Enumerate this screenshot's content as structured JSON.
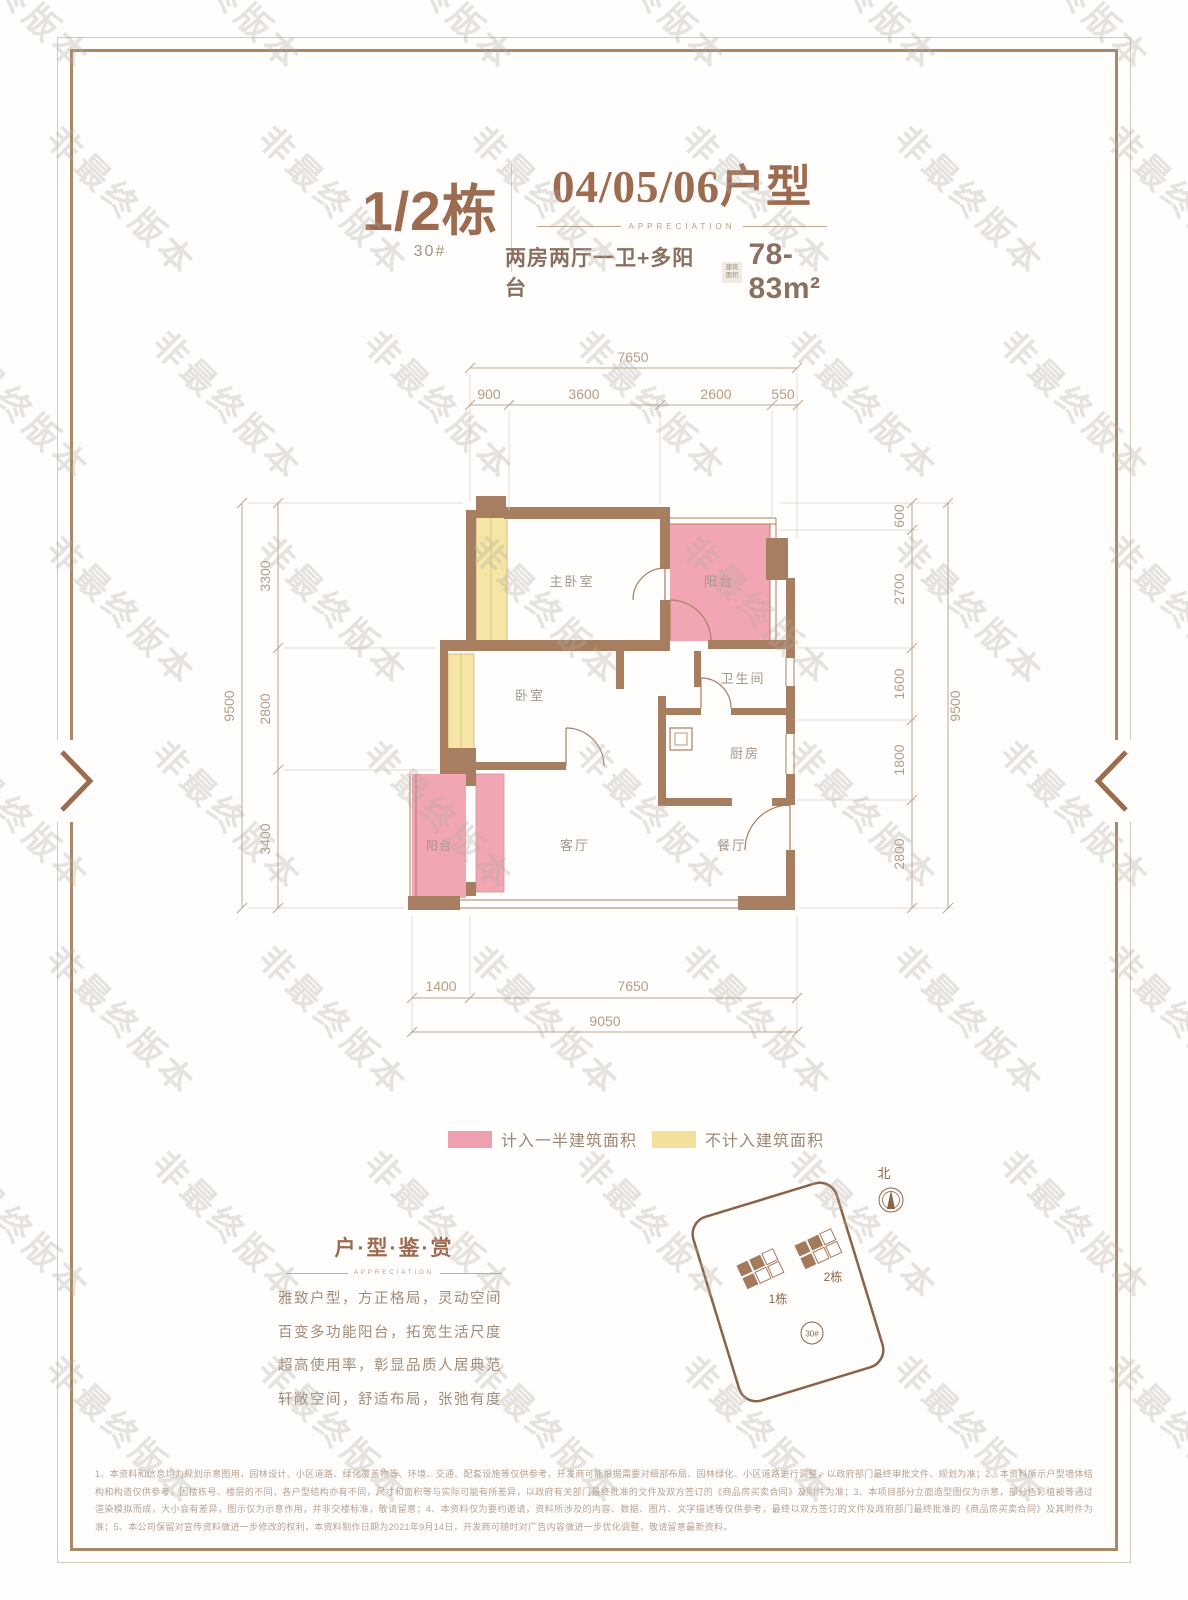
{
  "watermark": {
    "text": "非最终版本"
  },
  "colors": {
    "accent": "#9c6b50",
    "wall": "#a87e60",
    "half_area_pink": "#f2a6b4",
    "excluded_yellow": "#f5e6a6",
    "dim": "#bb9f88"
  },
  "header": {
    "building": "1/2栋",
    "building_no": "30#",
    "unit_title": "04/05/06户型",
    "unit_subtitle": "APPRECIATION",
    "layout_desc": "两房两厅一卫+多阳台",
    "area_badge_top": "建筑",
    "area_badge_bottom": "面积",
    "area_value": "78-83m²"
  },
  "plan": {
    "rooms": {
      "master": "主卧室",
      "balcony_top": "阳台",
      "bath": "卫生间",
      "kitchen": "厨房",
      "bedroom": "卧室",
      "living": "客厅",
      "dining": "餐厅",
      "balcony_bottom": "阳台"
    },
    "dims": {
      "top": {
        "overall": "7650",
        "segments": [
          "900",
          "3600",
          "2600",
          "550"
        ]
      },
      "left": {
        "overall": "9500",
        "segments": [
          "3300",
          "2800",
          "3400"
        ]
      },
      "right": {
        "overall": "9500",
        "segments": [
          "600",
          "2700",
          "1600",
          "1800",
          "2800"
        ]
      },
      "bottom": {
        "overall": "9050",
        "segments": [
          "1400",
          "7650"
        ]
      }
    }
  },
  "legend": {
    "half_area_label": "计入一半建筑面积",
    "excluded_label": "不计入建筑面积"
  },
  "appreciation": {
    "title": "户·型·鉴·赏",
    "subtitle": "APPRECIATION",
    "lines": [
      "雅致户型，方正格局，灵动空间",
      "百变多功能阳台，拓宽生活尺度",
      "超高使用率，彰显品质人居典范",
      "轩敞空间，舒适布局，张弛有度"
    ]
  },
  "siteplan": {
    "north_label": "北",
    "building1_label": "1栋",
    "building2_label": "2栋",
    "circle_label": "30#"
  },
  "disclaimer": "1、本资料和信息均为规划示意图用，园林设计、小区道路、绿化覆盖物等、环境、交通、配套设施等仅供参考，开发商可能根据需要对细部布局、园林绿化、小区道路进行调整，以政府部门最终审批文件、规划为准；2、本资料所示户型墙体结构和构造仅供参考，因楼栋号、楼层的不同，各户型结构亦有不同，尺寸和面积等与实际可能有所差异，以政府有关部门最终批准的文件及双方签订的《商品房买卖合同》及附件为准；3、本项目部分立面造型图仅为示意，部分色彩植被等通过渲染模拟而成，大小会有差异，图示仅为示意作用，并非交楼标准，敬请留意；4、本资料仅为要约邀请，资料所涉及的内容、数据、图片、文字描述等仅供参考，最终以双方签订的文件及政府部门最终批准的《商品房买卖合同》及其附件为准；5、本公司保留对宣传资料做进一步修改的权利，本资料制作日期为2021年9月14日，开发商可随时对广告内容做进一步优化调整，敬请留意最新资料。"
}
